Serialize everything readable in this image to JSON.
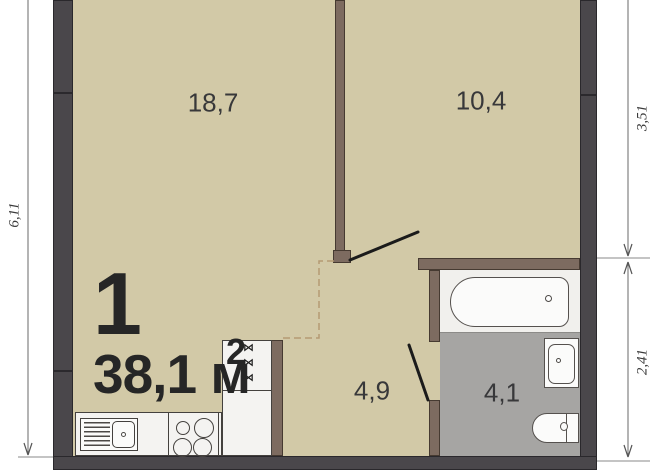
{
  "floorplan": {
    "unit": {
      "rooms_count": "1",
      "area_text": "38,1 м",
      "area_sup": "2"
    },
    "rooms": [
      {
        "position": "top-left-living-room",
        "area": "18,7"
      },
      {
        "position": "top-right-room",
        "area": "10,4"
      },
      {
        "position": "hallway-kitchen",
        "area": "4,9"
      },
      {
        "position": "bathroom",
        "area": "4,1"
      }
    ],
    "dimensions": [
      {
        "side": "left",
        "value": "6,11"
      },
      {
        "side": "right-top",
        "value": "3,51"
      },
      {
        "side": "right-bottom",
        "value": "2,41"
      }
    ],
    "vent_shaft": {
      "marks": [
        "⋈",
        "⋈",
        "⋈"
      ]
    },
    "colors": {
      "floor": "#d2c9a7",
      "exterior_wall": "#4a474b",
      "interior_wall": "#7d6b60",
      "bathroom_floor": "#a6a5a3",
      "fixture_fill": "#fbfbfa",
      "label_text": "#2a2a2a",
      "dash_line": "#b49a74"
    }
  }
}
